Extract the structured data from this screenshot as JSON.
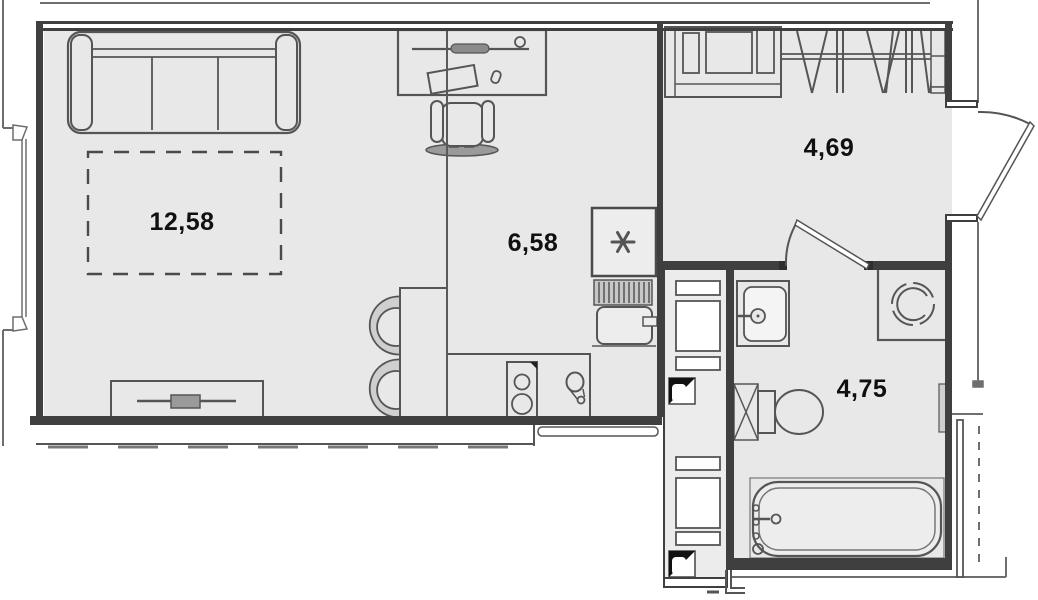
{
  "plan": {
    "type": "apartment-floor-plan",
    "rooms": [
      {
        "key": "living-room",
        "area_label": "12,58"
      },
      {
        "key": "kitchen",
        "area_label": "6,58"
      },
      {
        "key": "hallway",
        "area_label": "4,69"
      },
      {
        "key": "bathroom",
        "area_label": "4,75"
      }
    ],
    "fixtures": {
      "living_room": [
        "sofa",
        "furniture-zone-dashed",
        "tv-stand",
        "desk",
        "office-chair"
      ],
      "kitchen": [
        "dining-table",
        "chair",
        "chair",
        "counter",
        "stove-2-burner",
        "kitchen-sink",
        "refrigerator-snowflake",
        "under-counter-appliance"
      ],
      "hallway": [
        "shelf-cabinet",
        "open-wardrobe-hanger-rail",
        "entrance-door-swing"
      ],
      "bathroom": [
        "washbasin",
        "washing-machine",
        "toilet",
        "bathtub",
        "door-swing",
        "vent-shaft",
        "vent-shaft"
      ]
    },
    "colors": {
      "background": "#ffffff",
      "floor": "#e8e8e8",
      "wall": "#3f3f3f",
      "line": "#555555",
      "label": "#101010"
    }
  }
}
